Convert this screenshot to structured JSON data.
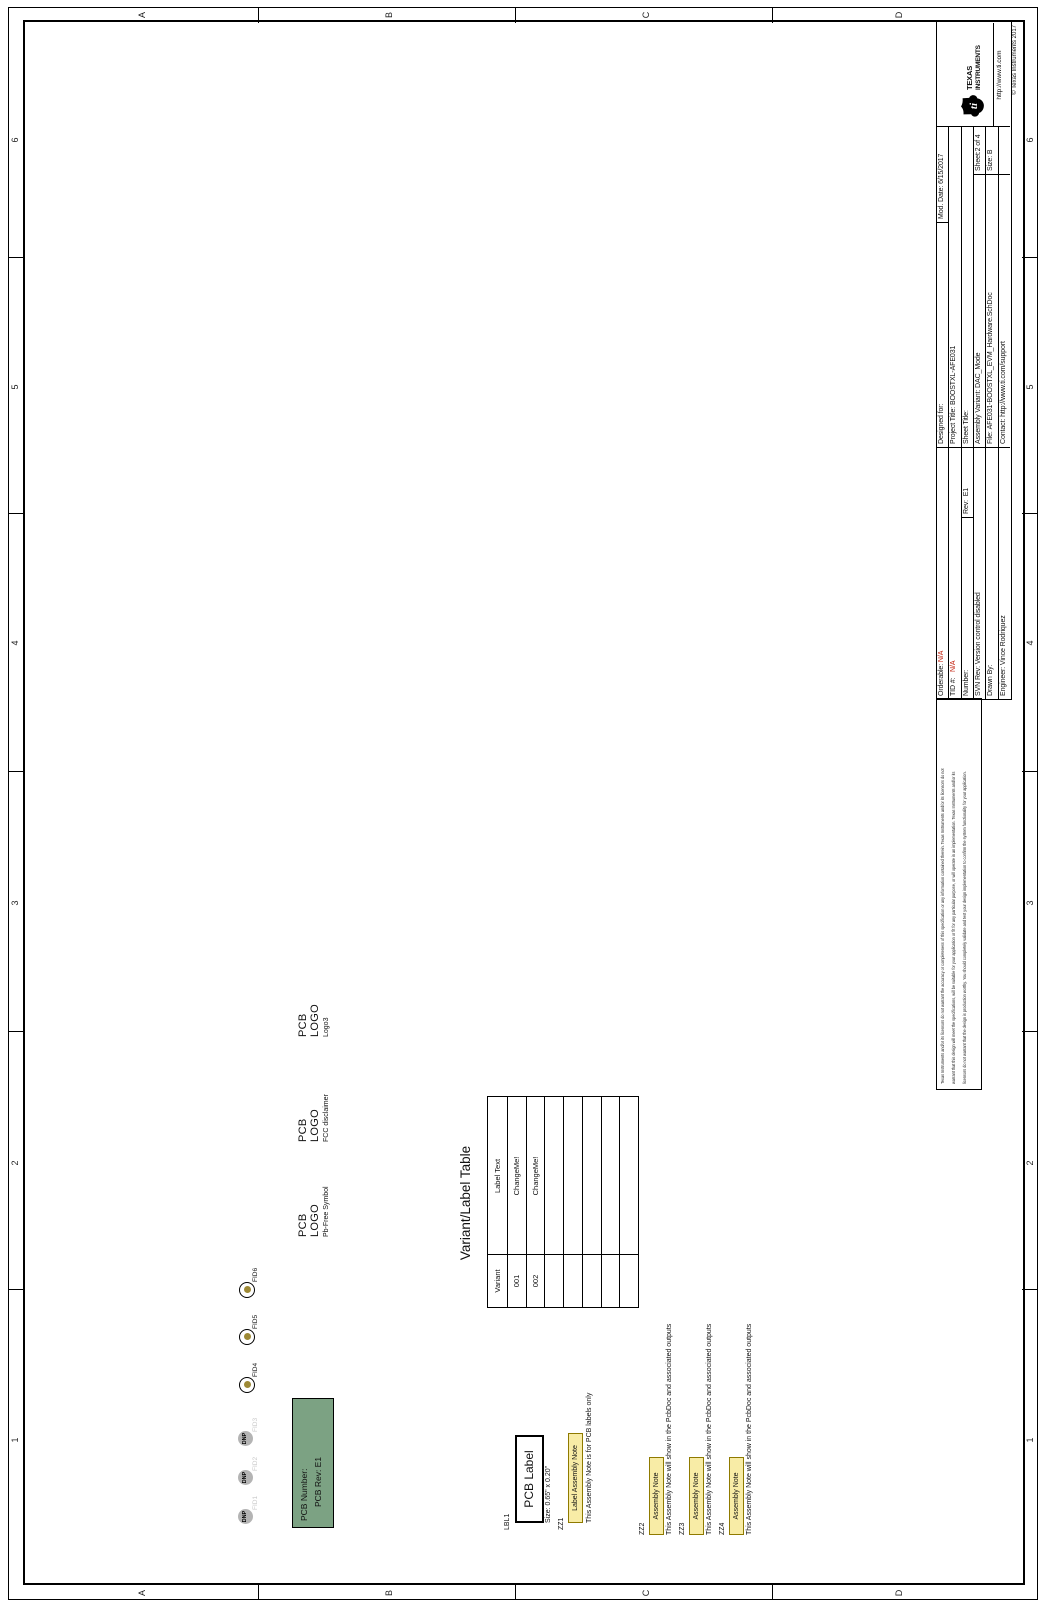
{
  "sheet": {
    "zone_letters": [
      "A",
      "B",
      "C",
      "D"
    ],
    "zone_numbers": [
      "1",
      "2",
      "3",
      "4",
      "5",
      "6"
    ]
  },
  "fiducials": {
    "dnp_label": "DNP",
    "items": [
      {
        "label": "FID1",
        "dnp": true
      },
      {
        "label": "FID2",
        "dnp": true
      },
      {
        "label": "FID3",
        "dnp": true
      },
      {
        "label": "FID4",
        "dnp": false
      },
      {
        "label": "FID5",
        "dnp": false
      },
      {
        "label": "FID6",
        "dnp": false
      }
    ]
  },
  "pcb_number_box": {
    "line1": "PCB Number:",
    "line2": "PCB Rev: E1"
  },
  "pcb_logos": [
    {
      "line1": "PCB",
      "line2": "LOGO",
      "subtitle": "Pb-Free Symbol"
    },
    {
      "line1": "PCB",
      "line2": "LOGO",
      "subtitle": "FCC disclaimer"
    },
    {
      "line1": "PCB",
      "line2": "LOGO",
      "subtitle": "Logo3"
    }
  ],
  "variant_table": {
    "title": "Variant/Label Table",
    "rows": [
      [
        "Variant",
        "Label Text"
      ],
      [
        "001",
        "ChangeMe!"
      ],
      [
        "002",
        "ChangeMe!"
      ],
      [
        "",
        ""
      ],
      [
        "",
        ""
      ],
      [
        "",
        ""
      ],
      [
        "",
        ""
      ],
      [
        "",
        ""
      ]
    ]
  },
  "pcb_label": {
    "ref": "LBL1",
    "text": "PCB Label",
    "size": "Size: 0.65\" x 0.20\""
  },
  "assembly_notes": [
    {
      "ref": "ZZ1",
      "title": "Label Assembly Note",
      "text": "This Assembly Note is for PCB labels only"
    },
    {
      "ref": "ZZ2",
      "title": "Assembly Note",
      "text": "This Assembly Note will show in the PcbDoc and associated outputs"
    },
    {
      "ref": "ZZ3",
      "title": "Assembly Note",
      "text": "This Assembly Note will show in the PcbDoc and associated outputs"
    },
    {
      "ref": "ZZ4",
      "title": "Assembly Note",
      "text": "This Assembly Note will show in the PcbDoc and associated outputs"
    }
  ],
  "disclaimer": {
    "line1": "Texas Instruments and/or its licensors do not warrant the accuracy or completeness of this specification or any information contained therein. Texas Instruments and/or its licensors do not",
    "line2": "warrant that this design will meet the specifications, will be suitable for your application or fit for any particular purpose, or will operate in an implementation. Texas Instruments and/or its",
    "line3": "licensors do not warrant that the design is production worthy. You should completely validate and test your design implementation to confirm the system functionality for your application."
  },
  "title_block": {
    "orderable_label": "Orderable:",
    "orderable_value": "N/A",
    "tid_label": "TID #:",
    "tid_value": "N/A",
    "number_label": "Number:",
    "rev_label": "Rev:",
    "rev_value": "E1",
    "svn_label": "SVN Rev:",
    "svn_value": "Version control disabled",
    "drawn_by_label": "Drawn By:",
    "engineer_label": "Engineer:",
    "engineer_value": "Vince Rodriquez",
    "designed_for_label": "Designed for:",
    "project_title_label": "Project Title:",
    "project_title_value": "BOOSTXL-AFE031",
    "sheet_title_label": "Sheet Title:",
    "assembly_variant_label": "Assembly Variant:",
    "assembly_variant_value": "DAC_Mode",
    "file_label": "File:",
    "file_value": "AFE031-BOOSTXL_EVM_Hardware.SchDoc",
    "contact_label": "Contact:",
    "contact_value": "http://www.ti.com/support",
    "mod_date_label": "Mod. Date:",
    "mod_date_value": "6/15/2017",
    "sheet_label": "Sheet:",
    "sheet_value": "2 of 4",
    "size_label": "Size:",
    "size_value": "B",
    "logo_name_line1": "TEXAS",
    "logo_name_line2": "INSTRUMENTS",
    "ti_url": "http://www.ti.com",
    "copyright": "© Texas Instruments 2017"
  },
  "colors": {
    "na_red": "#c01400",
    "green_fill": "#7ca283",
    "note_yellow": "#f8eca6",
    "note_border": "#8f7a00",
    "fiducial_dot": "#9d8935",
    "dnp_gray": "#b4b4b4",
    "dnp_label_gray": "#c9c9c9"
  }
}
